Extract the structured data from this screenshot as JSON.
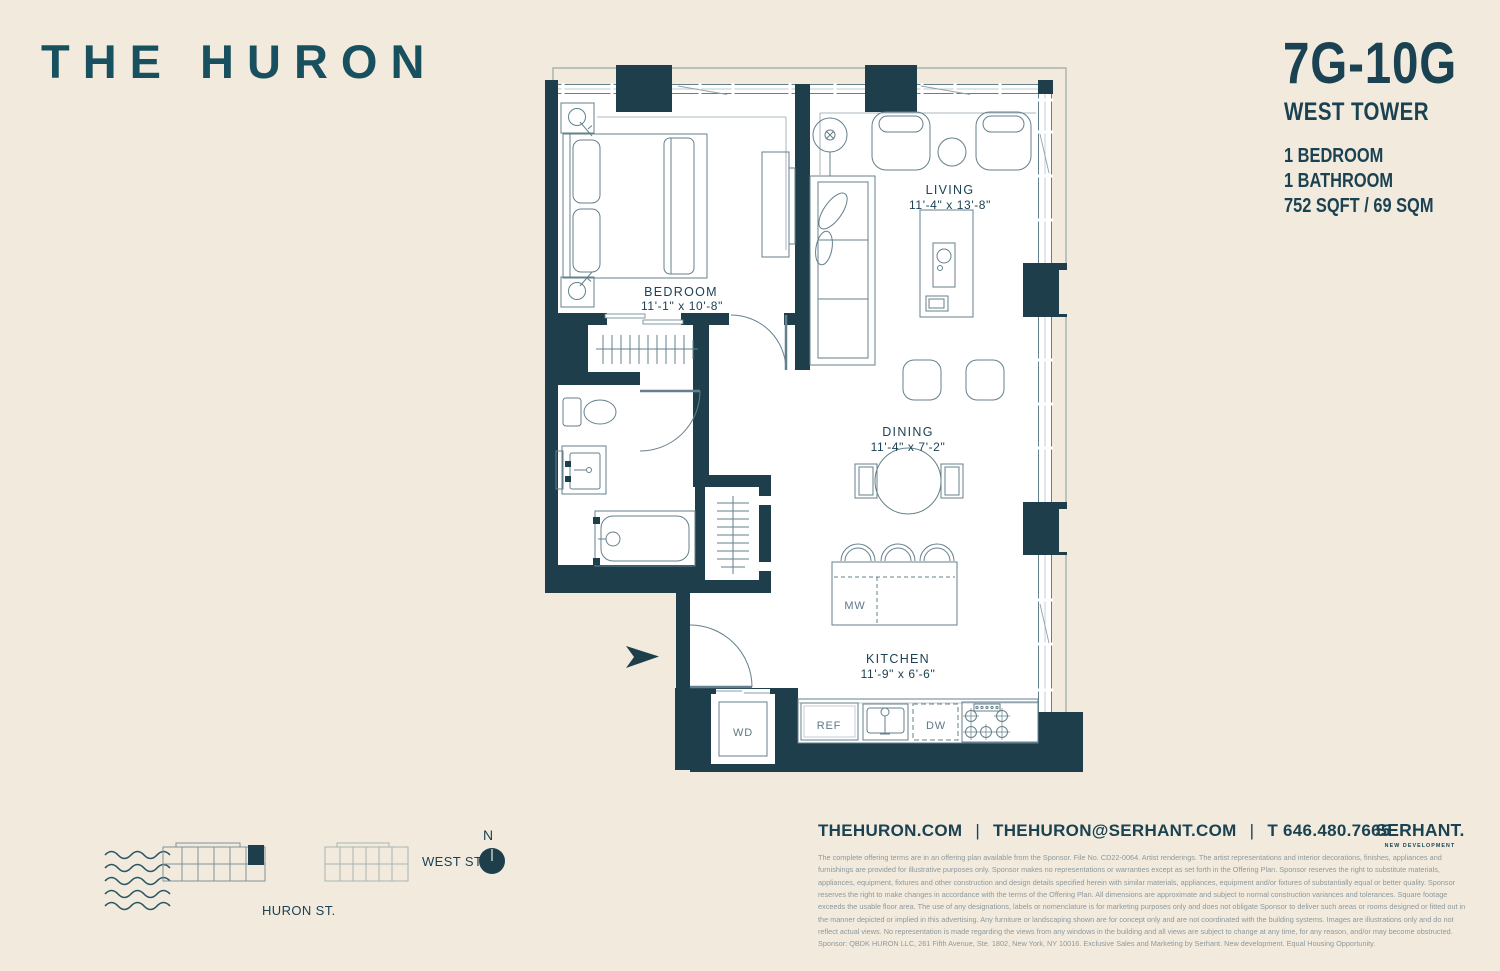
{
  "colors": {
    "background": "#F2EBDD",
    "wall": "#1E3E4C",
    "brand_teal": "#19505F",
    "text_teal": "#1B4252",
    "plan_line": "#64808C",
    "light_line": "#8FA3AC",
    "legal_gray": "#8D989D"
  },
  "header": {
    "logo": "THE HURON"
  },
  "unit_panel": {
    "unit": "7G-10G",
    "tower": "WEST TOWER",
    "features": [
      "1 BEDROOM",
      "1 BATHROOM",
      "752 SQFT / 69 SQM"
    ]
  },
  "floor_plan": {
    "rooms": [
      {
        "name": "BEDROOM",
        "dimensions": "11'-1\" x 10'-8\""
      },
      {
        "name": "LIVING",
        "dimensions": "11'-4\" x 13'-8\""
      },
      {
        "name": "DINING",
        "dimensions": "11'-4\" x 7'-2\""
      },
      {
        "name": "KITCHEN",
        "dimensions": "11'-9\" x 6'-6\""
      }
    ],
    "fixtures": {
      "mw": "MW",
      "wd": "WD",
      "ref": "REF",
      "dw": "DW"
    }
  },
  "site_map": {
    "west_st": "WEST ST.",
    "huron_st": "HURON ST.",
    "compass": "N"
  },
  "footer": {
    "website": "THEHURON.COM",
    "email": "THEHURON@SERHANT.COM",
    "phone": "T 646.480.7665",
    "separator": "|",
    "brand": "SERHANT.",
    "brand_sub": "NEW DEVELOPMENT",
    "legal": "The complete offering terms are in an offering plan available from the Sponsor. File No. CD22-0064. Artist renderings. The artist representations and interior decorations, finishes, appliances and furnishings are provided for illustrative purposes only. Sponsor makes no representations or warranties except as set forth in the Offering Plan. Sponsor reserves the right to substitute materials, appliances, equipment, fixtures and other construction and design details specified herein with similar materials, appliances, equipment and/or fixtures of substantially equal or better quality. Sponsor reserves the right to make changes in accordance with the terms of the Offering Plan. All dimensions are approximate and subject to normal construction variances and tolerances. Square footage exceeds the usable floor area. The use of any designations, labels or nomenclature is for marketing purposes only and does not obligate Sponsor to deliver such areas or rooms designed or fitted out in the manner depicted or implied in this advertising. Any furniture or landscaping shown are for concept only and are not coordinated with the building systems. Images are illustrations only and do not reflect actual views. No representation is made regarding the views from any windows in the building and all views are subject to change at any time, for any reason, and/or may become obstructed. Sponsor: QBDK HURON LLC, 261 Fifth Avenue, Ste. 1802, New York, NY 10016. Exclusive Sales and Marketing by Serhant. New development. Equal Housing Opportunity."
  }
}
